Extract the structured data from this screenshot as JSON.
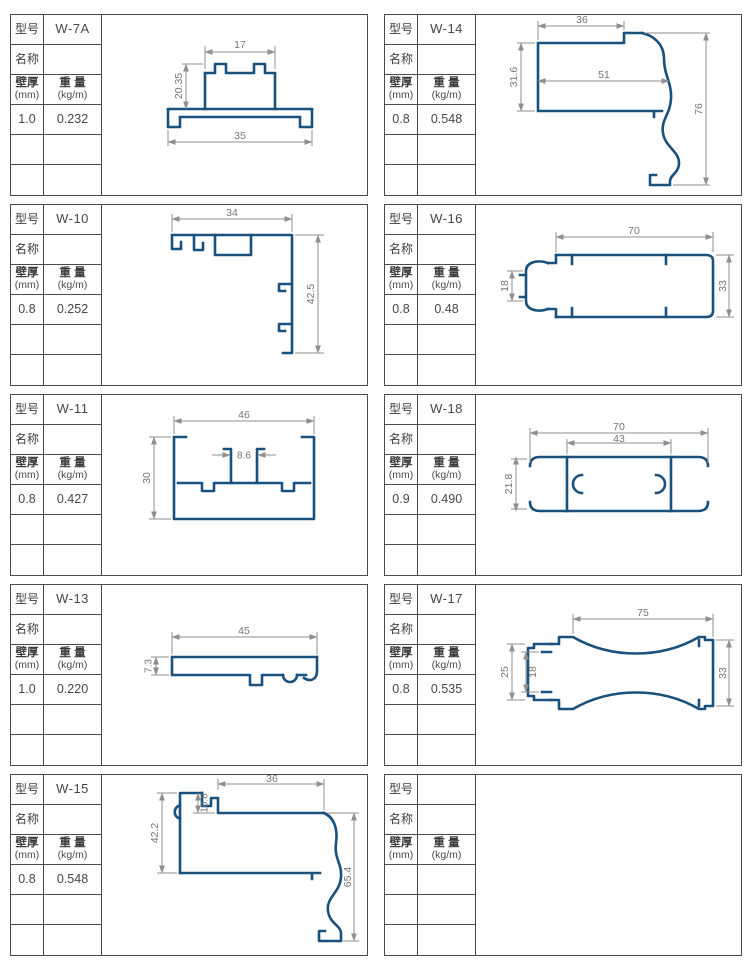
{
  "labels": {
    "model": "型号",
    "name": "名称",
    "th1": "壁厚",
    "th2": "(mm)",
    "wt1": "重 量",
    "wt2": "(kg/m)"
  },
  "colors": {
    "profile_blue": "#19517d",
    "dimension_gray": "#8f8f8f",
    "table_border": "#4a4a4a",
    "background": "#fdfdfd"
  },
  "cells": [
    {
      "model": "W-7A",
      "name": "",
      "thickness": "1.0",
      "weight": "0.232",
      "dims": {
        "d1": "17",
        "d2": "20.35",
        "d3": "35"
      }
    },
    {
      "model": "W-14",
      "name": "",
      "thickness": "0.8",
      "weight": "0.548",
      "dims": {
        "d1": "36",
        "d2": "51",
        "d3": "31.6",
        "d4": "76"
      }
    },
    {
      "model": "W-10",
      "name": "",
      "thickness": "0.8",
      "weight": "0.252",
      "dims": {
        "d1": "34",
        "d2": "42.5"
      }
    },
    {
      "model": "W-16",
      "name": "",
      "thickness": "0.8",
      "weight": "0.48",
      "dims": {
        "d1": "70",
        "d2": "18",
        "d3": "33"
      }
    },
    {
      "model": "W-11",
      "name": "",
      "thickness": "0.8",
      "weight": "0.427",
      "dims": {
        "d1": "46",
        "d2": "8.6",
        "d3": "30"
      }
    },
    {
      "model": "W-18",
      "name": "",
      "thickness": "0.9",
      "weight": "0.490",
      "dims": {
        "d1": "70",
        "d2": "43",
        "d3": "21.8"
      }
    },
    {
      "model": "W-13",
      "name": "",
      "thickness": "1.0",
      "weight": "0.220",
      "dims": {
        "d1": "45",
        "d2": "7.3"
      }
    },
    {
      "model": "W-17",
      "name": "",
      "thickness": "0.8",
      "weight": "0.535",
      "dims": {
        "d1": "75",
        "d2": "25",
        "d3": "18",
        "d4": "33"
      }
    },
    {
      "model": "W-15",
      "name": "",
      "thickness": "0.8",
      "weight": "0.548",
      "dims": {
        "d1": "36",
        "d2": "10.6",
        "d3": "42.2",
        "d4": "65.4"
      }
    },
    {
      "model": "",
      "name": "",
      "thickness": "",
      "weight": ""
    }
  ]
}
